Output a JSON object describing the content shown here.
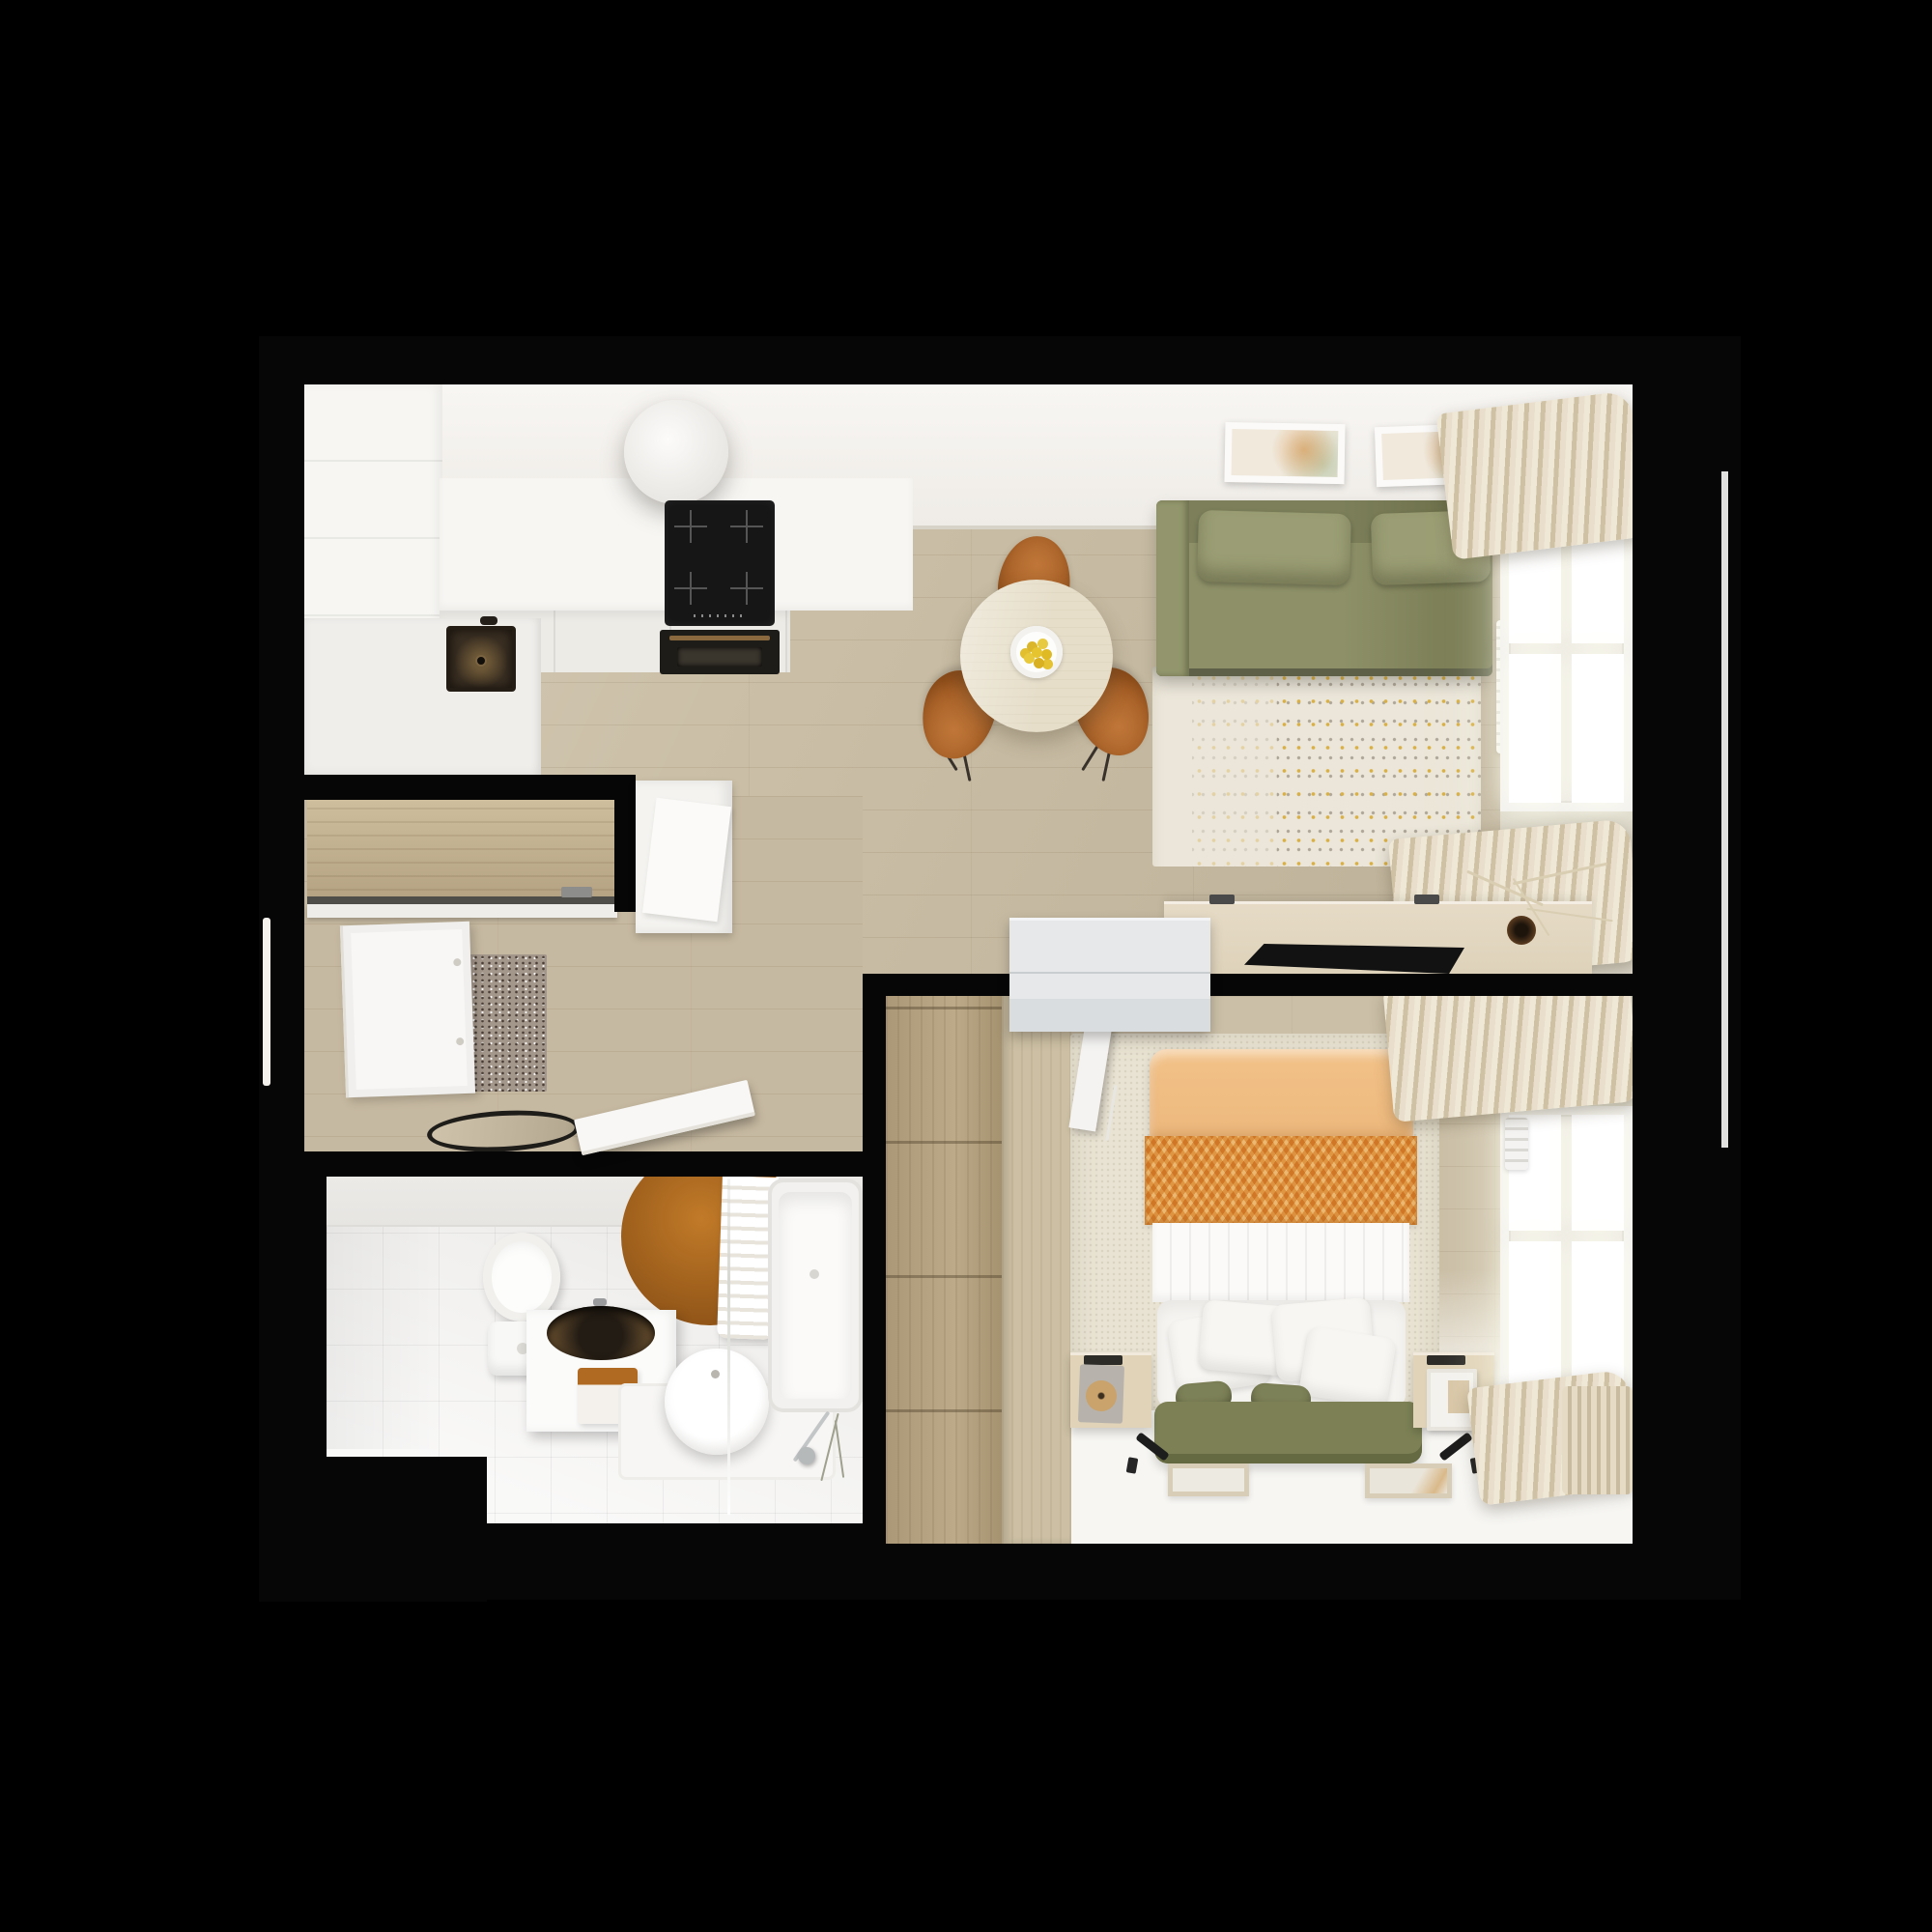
{
  "scene": {
    "title": "Top-down 3D render of a one-bedroom apartment floor plan",
    "view": "overhead photoreal render",
    "background": "black"
  },
  "palette": {
    "bg": "#000000",
    "black_wall": "#060606",
    "wall_white": "#f3f1ed",
    "wall_beige": "#d9d4c6",
    "cabinet_white": "#f7f6f3",
    "counter_front": "#edebe6",
    "floor_wood": "#cbbfa7",
    "floor_hall": "#c6b9a1",
    "cooktop_black": "#161616",
    "oven_black": "#1e1c19",
    "oven_handle": "#8a693f",
    "table_wood": "#e6dec9",
    "chair_caramel": "#b26c30",
    "lemon_yellow": "#e5c42f",
    "sofa_green": "#8e9168",
    "sofa_green_dark": "#74774f",
    "cushion_green": "#9b9e74",
    "rug_cream": "#ebe6d9",
    "rug_dot_yellow": "#d6a72c",
    "rug_dot_gray": "#a59d8e",
    "rug_bed": "#e9e3d3",
    "console_wood": "#ded2ba",
    "tv_black": "#121212",
    "dresser_white": "#e6e8e9",
    "wardrobe_wood": "#c0ae8c",
    "closet_white": "#f4f3f0",
    "door_white": "#f8f7f5",
    "doormat": "#a3968a",
    "mirror_frame": "#1f1d1a",
    "tile_light": "#f1f0ee",
    "copper": "#b06a22",
    "towel_white": "#f7f5f1",
    "bed_orange": "#edb87c",
    "duvet_white": "#fbfaf8",
    "pillow_white": "#f8f6f2",
    "bench_olive": "#7c8054",
    "nightstand_wood": "#e0d3b8",
    "frame_beige": "#d8cdb6",
    "window_glow": "#ffffff",
    "curtain_beige": "#dccfb2",
    "radiator_white": "#f4f3f1",
    "glass_line": "#d8d8d2"
  },
  "rooms": [
    {
      "name": "kitchen-living-dining",
      "furniture": [
        "tall white cabinets",
        "white counter",
        "bronze sink",
        "induction cooktop",
        "built-in oven",
        "round extractor hood",
        "round dining table",
        "plate of lemons",
        "three caramel chairs",
        "green three-seat sofa",
        "two green cushions",
        "cream rug with yellow-gray dots",
        "two framed artworks",
        "wood tv sideboard",
        "flat tv",
        "vase with dried branches",
        "white dresser",
        "window",
        "beige curtains",
        "radiator"
      ]
    },
    {
      "name": "entry-hall",
      "furniture": [
        "sliding-door wardrobe",
        "white closet",
        "entry door",
        "speckled doormat",
        "black oval mirror",
        "bathroom door"
      ]
    },
    {
      "name": "bathroom",
      "furniture": [
        "toilet",
        "vanity with dark round basin",
        "copper circle wall art",
        "hanging towels",
        "glass shower screen",
        "round freestanding washbasin",
        "bathtub",
        "hand shower",
        "flower sprigs"
      ]
    },
    {
      "name": "bedroom",
      "furniture": [
        "full-height wood wardrobe",
        "tv panel",
        "double bed with orange duvet",
        "herringbone throw",
        "white duvet",
        "four white pillows",
        "olive bolsters",
        "olive headboard bench",
        "two wood nightstands",
        "felt cloth",
        "magazine",
        "two black wall sconces",
        "two leaning picture frames",
        "beige rug",
        "planter with driftwood",
        "window",
        "beige curtains",
        "radiator"
      ]
    }
  ]
}
